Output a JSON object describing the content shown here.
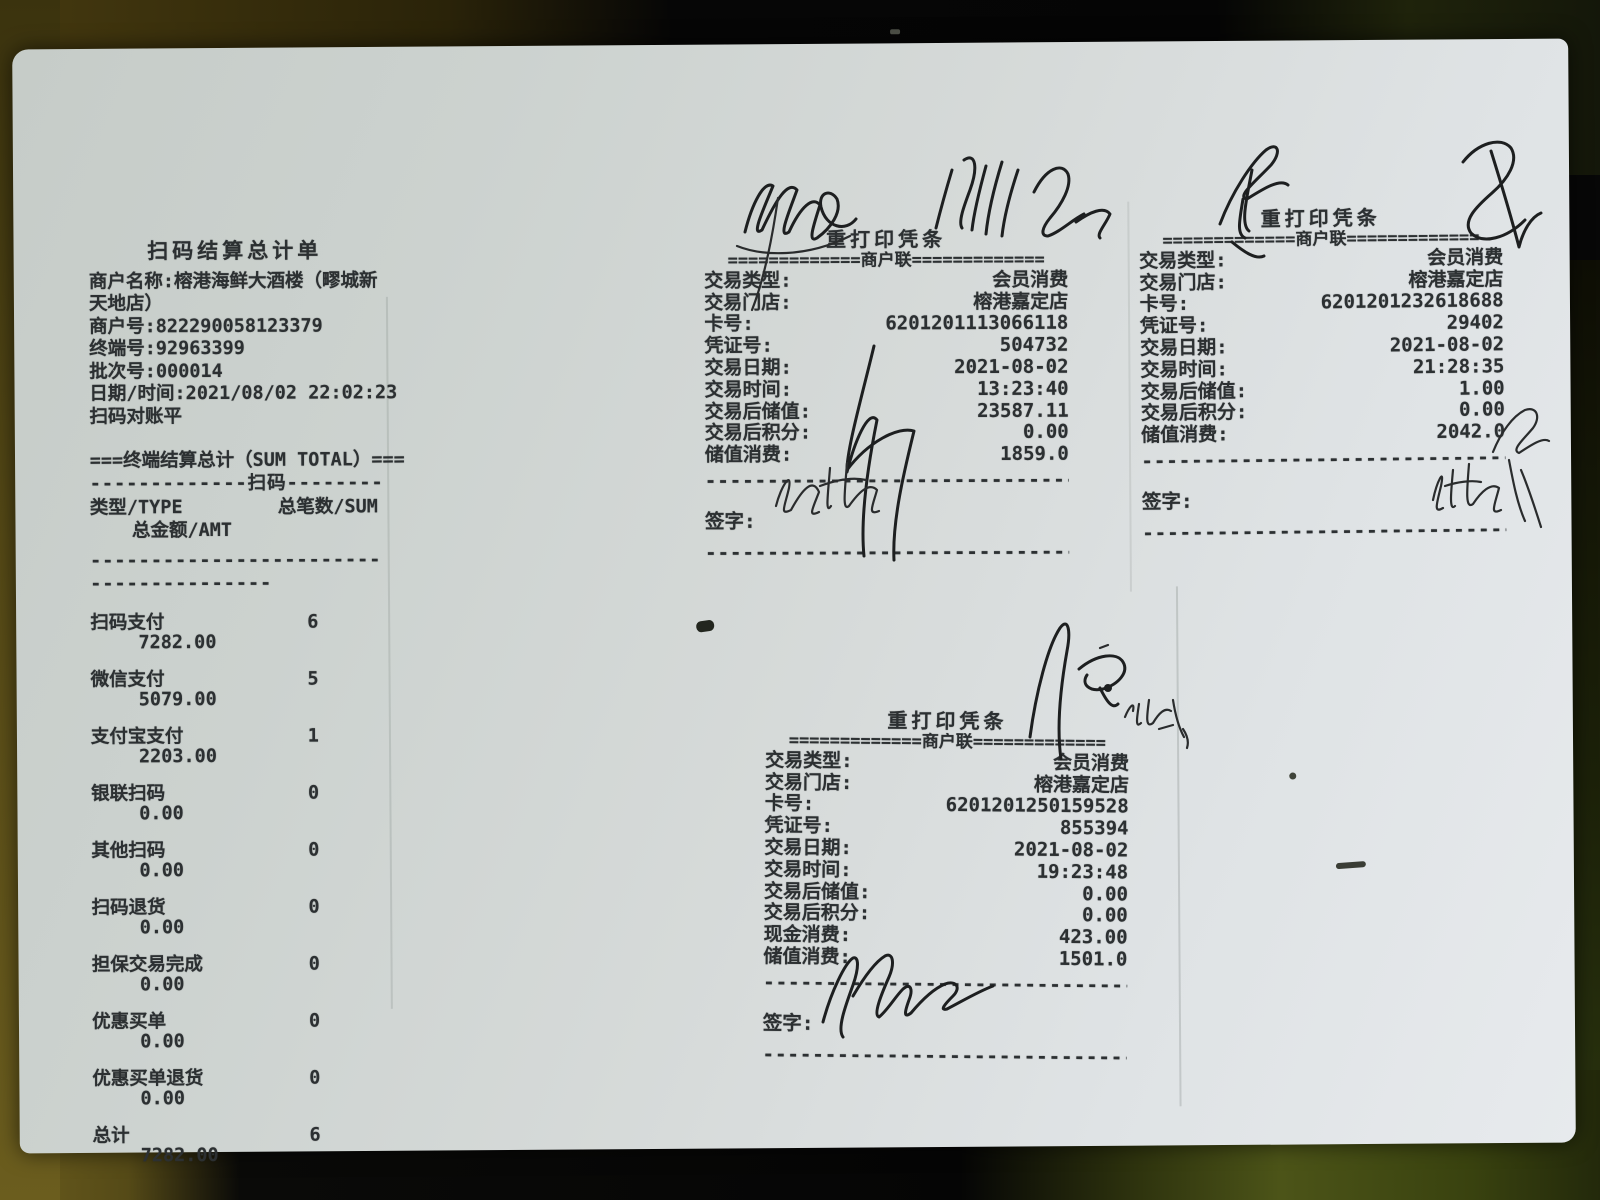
{
  "summary": {
    "title": "扫码结算总计单",
    "header_lines": [
      "商户名称:榕港海鲜大酒楼（疁城新",
      "天地店）",
      "商户号:822290058123379",
      "终端号:92963399",
      "批次号:000014",
      "日期/时间:2021/08/02 22:02:23",
      "扫码对账平"
    ],
    "section_title": "===终端结算总计（SUM TOTAL）===",
    "scan_divider": "-------------扫码--------------",
    "col_type": "类型/TYPE",
    "col_count": "总笔数/SUM",
    "col_amount": "总金额/AMT",
    "divider_long": "---------------------------",
    "divider_short": "------------------",
    "rows": [
      {
        "label": "扫码支付",
        "count": "6",
        "amount": "7282.00"
      },
      {
        "label": "微信支付",
        "count": "5",
        "amount": "5079.00"
      },
      {
        "label": "支付宝支付",
        "count": "1",
        "amount": "2203.00"
      },
      {
        "label": "银联扫码",
        "count": "0",
        "amount": "0.00"
      },
      {
        "label": "其他扫码",
        "count": "0",
        "amount": "0.00"
      },
      {
        "label": "扫码退货",
        "count": "0",
        "amount": "0.00"
      },
      {
        "label": "担保交易完成",
        "count": "0",
        "amount": "0.00"
      },
      {
        "label": "优惠买单",
        "count": "0",
        "amount": "0.00"
      },
      {
        "label": "优惠买单退货",
        "count": "0",
        "amount": "0.00"
      },
      {
        "label": "总计",
        "count": "6",
        "amount": "7282.00"
      }
    ]
  },
  "vouchers": [
    {
      "title": "重打印凭条",
      "subtitle": "=============商户联=============",
      "rows": [
        {
          "label": "交易类型:",
          "value": "会员消费"
        },
        {
          "label": "交易门店:",
          "value": "榕港嘉定店"
        },
        {
          "label": "卡号:",
          "value": "6201201113066118"
        },
        {
          "label": "凭证号:",
          "value": "504732"
        },
        {
          "label": "交易日期:",
          "value": "2021-08-02"
        },
        {
          "label": "交易时间:",
          "value": "13:23:40"
        },
        {
          "label": "交易后储值:",
          "value": "23587.11"
        },
        {
          "label": "交易后积分:",
          "value": "0.00"
        },
        {
          "label": "储值消费:",
          "value": "1859.0"
        }
      ],
      "sign_label": "签字:",
      "divider": "--------------------------------"
    },
    {
      "title": "重打印凭条",
      "subtitle": "=============商户联=============",
      "rows": [
        {
          "label": "交易类型:",
          "value": "会员消费"
        },
        {
          "label": "交易门店:",
          "value": "榕港嘉定店"
        },
        {
          "label": "卡号:",
          "value": "6201201232618688"
        },
        {
          "label": "凭证号:",
          "value": "29402"
        },
        {
          "label": "交易日期:",
          "value": "2021-08-02"
        },
        {
          "label": "交易时间:",
          "value": "21:28:35"
        },
        {
          "label": "交易后储值:",
          "value": "1.00"
        },
        {
          "label": "交易后积分:",
          "value": "0.00"
        },
        {
          "label": "储值消费:",
          "value": "2042.0"
        }
      ],
      "sign_label": "签字:",
      "divider": "--------------------------------"
    },
    {
      "title": "重打印凭条",
      "subtitle": "=============商户联=============",
      "rows": [
        {
          "label": "交易类型:",
          "value": "会员消费"
        },
        {
          "label": "交易门店:",
          "value": "榕港嘉定店"
        },
        {
          "label": "卡号:",
          "value": "6201201250159528"
        },
        {
          "label": "凭证号:",
          "value": "855394"
        },
        {
          "label": "交易日期:",
          "value": "2021-08-02"
        },
        {
          "label": "交易时间:",
          "value": "19:23:48"
        },
        {
          "label": "交易后储值:",
          "value": "0.00"
        },
        {
          "label": "交易后积分:",
          "value": "0.00"
        },
        {
          "label": "现金消费:",
          "value": "423.00"
        },
        {
          "label": "储值消费:",
          "value": "1501.0"
        }
      ],
      "sign_label": "签字:",
      "divider": "--------------------------------"
    }
  ],
  "colors": {
    "paper": "#d6dad9",
    "ink": "#2c3032",
    "table_olive": "#554916",
    "backdrop_black": "#070707"
  }
}
